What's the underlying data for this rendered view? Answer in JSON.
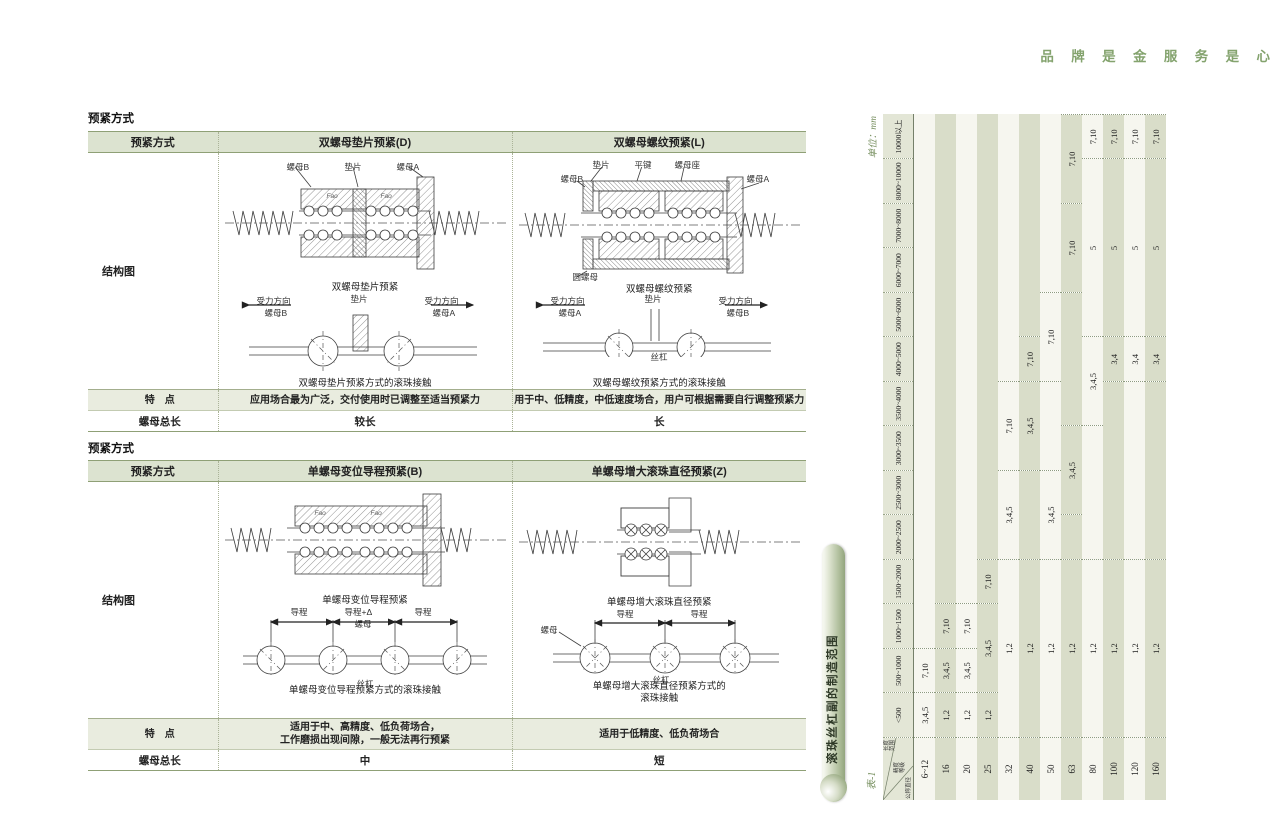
{
  "page_header": {
    "slogan": "品 牌 是 金 服 务 是 心"
  },
  "left": {
    "section1": {
      "label": "预紧方式",
      "col_headers": [
        "预紧方式",
        "双螺母垫片预紧(D)",
        "双螺母螺纹预紧(L)"
      ],
      "row_labels": {
        "diagram": "结构图",
        "feature": "特　点",
        "nut_length": "螺母总长"
      },
      "d": {
        "top_labels": [
          "螺母B",
          "垫片",
          "螺母A"
        ],
        "fao": "Fao",
        "cap1": "双螺母垫片预紧",
        "force_left1": "受力方向",
        "force_left2": "螺母B",
        "mid_label": "垫片",
        "force_right1": "受力方向",
        "force_right2": "螺母A",
        "cap2": "双螺母垫片预紧方式的滚珠接触",
        "feature": "应用场合最为广泛，交付使用时已调整至适当预紧力",
        "nut_length": "较长"
      },
      "l": {
        "top_labels": [
          "垫片",
          "平键",
          "螺母座"
        ],
        "side_labels": {
          "nut_b": "螺母B",
          "nut_a": "螺母A",
          "round_nut": "圆螺母"
        },
        "cap1": "双螺母螺纹预紧",
        "force_left1": "受力方向",
        "force_left2": "螺母A",
        "mid_label": "垫片",
        "force_right1": "受力方向",
        "force_right2": "螺母B",
        "shaft": "丝杠",
        "cap2": "双螺母螺纹预紧方式的滚珠接触",
        "feature": "用于中、低精度，中低速度场合，用户可根据需要自行调整预紧力",
        "nut_length": "长"
      }
    },
    "section2": {
      "label": "预紧方式",
      "col_headers": [
        "预紧方式",
        "单螺母变位导程预紧(B)",
        "单螺母增大滚珠直径预紧(Z)"
      ],
      "row_labels": {
        "diagram": "结构图",
        "feature": "特　点",
        "nut_length": "螺母总长"
      },
      "b": {
        "fao": "Fao",
        "cap1": "单螺母变位导程预紧",
        "dims": [
          "导程",
          "导程+Δ",
          "导程"
        ],
        "nut": "螺母",
        "shaft": "丝杠",
        "cap2": "单螺母变位导程预紧方式的滚珠接触",
        "feature_line1": "适用于中、高精度、低负荷场合，",
        "feature_line2": "工作磨损出现间隙，一般无法再行预紧",
        "nut_length": "中"
      },
      "z": {
        "cap1": "单螺母增大滚珠直径预紧",
        "dims": [
          "导程",
          "导程"
        ],
        "nut": "螺母",
        "shaft": "丝杠",
        "cap2_line1": "单螺母增大滚珠直径预紧方式的",
        "cap2_line2": "滚珠接触",
        "feature": "适用于低精度、低负荷场合",
        "nut_length": "短"
      }
    }
  },
  "right_table": {
    "table_no": "表-1",
    "title": "滚珠丝杠副的制造范围",
    "unit": "单位：mm",
    "corner": {
      "top": "长度范围",
      "mid": "精度等级",
      "bottom": "公称直径"
    },
    "length_headers": [
      "<500",
      "500~1000",
      "1000~1500",
      "1500~2000",
      "2000~2500",
      "2500~3000",
      "3000~3500",
      "3500~4000",
      "4000~5000",
      "5000~6000",
      "6000~7000",
      "7000~8000",
      "8000~10000",
      "10000以上"
    ],
    "rows": [
      {
        "dia": "6~12",
        "segments": [
          [
            "3,4,5",
            0,
            0
          ],
          [
            "7,10",
            1,
            1
          ]
        ]
      },
      {
        "dia": "16",
        "segments": [
          [
            "1,2",
            0,
            0
          ],
          [
            "3,4,5",
            1,
            1
          ],
          [
            "7,10",
            2,
            2
          ]
        ]
      },
      {
        "dia": "20",
        "segments": [
          [
            "1,2",
            0,
            0
          ],
          [
            "3,4,5",
            1,
            1
          ],
          [
            "7,10",
            2,
            2
          ]
        ]
      },
      {
        "dia": "25",
        "segments": [
          [
            "1,2",
            0,
            0
          ],
          [
            "3,4,5",
            1,
            2
          ],
          [
            "7,10",
            3,
            3
          ]
        ]
      },
      {
        "dia": "32",
        "segments": [
          [
            "1,2",
            0,
            3
          ],
          [
            "3,4,5",
            4,
            5
          ],
          [
            "7,10",
            6,
            7
          ]
        ]
      },
      {
        "dia": "40",
        "segments": [
          [
            "1,2",
            0,
            3
          ],
          [
            "3,4,5",
            6,
            7
          ],
          [
            "7,10",
            8,
            8
          ]
        ]
      },
      {
        "dia": "50",
        "segments": [
          [
            "1,2",
            0,
            3
          ],
          [
            "3,4,5",
            4,
            5
          ],
          [
            "7,10",
            8,
            9
          ]
        ]
      },
      {
        "dia": "63",
        "segments": [
          [
            "1,2",
            0,
            3
          ],
          [
            "3,4,5",
            5,
            6
          ],
          [
            "7,10",
            10,
            11
          ],
          [
            "7,10",
            12,
            13
          ]
        ]
      },
      {
        "dia": "80",
        "segments": [
          [
            "1,2",
            0,
            3
          ],
          [
            "3,4,5",
            7,
            8
          ],
          [
            "5",
            9,
            12
          ],
          [
            "7,10",
            13,
            13
          ]
        ]
      },
      {
        "dia": "100",
        "segments": [
          [
            "1,2",
            0,
            3
          ],
          [
            "3,4",
            8,
            8
          ],
          [
            "5",
            9,
            12
          ],
          [
            "7,10",
            13,
            13
          ]
        ]
      },
      {
        "dia": "120",
        "segments": [
          [
            "1,2",
            0,
            3
          ],
          [
            "3,4",
            8,
            8
          ],
          [
            "5",
            9,
            12
          ],
          [
            "7,10",
            13,
            13
          ]
        ]
      },
      {
        "dia": "160",
        "segments": [
          [
            "1,2",
            0,
            3
          ],
          [
            "3,4",
            8,
            8
          ],
          [
            "5",
            9,
            12
          ],
          [
            "7,10",
            13,
            13
          ]
        ]
      }
    ]
  }
}
